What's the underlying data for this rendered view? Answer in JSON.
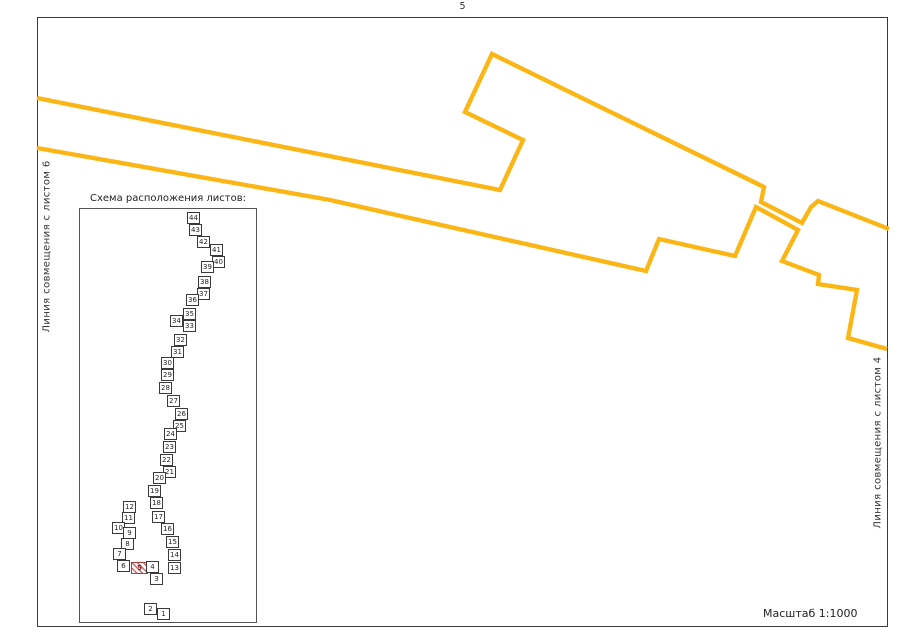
{
  "page": {
    "sheet_number": "5",
    "scale_label": "Масштаб 1:1000",
    "match_line_left": "Линия совмещения с листом 6",
    "match_line_right": "Линия совмещения с листом 4"
  },
  "scheme": {
    "title": "Схема расположения листов:",
    "current_sheet": 5,
    "sheets": [
      {
        "n": 1,
        "x": 157,
        "y": 608
      },
      {
        "n": 2,
        "x": 144,
        "y": 603
      },
      {
        "n": 3,
        "x": 150,
        "y": 573
      },
      {
        "n": 4,
        "x": 146,
        "y": 561
      },
      {
        "n": 5,
        "x": 131,
        "y": 562,
        "w": 17
      },
      {
        "n": 6,
        "x": 117,
        "y": 560
      },
      {
        "n": 7,
        "x": 113,
        "y": 548
      },
      {
        "n": 8,
        "x": 121,
        "y": 538
      },
      {
        "n": 9,
        "x": 123,
        "y": 527
      },
      {
        "n": 10,
        "x": 112,
        "y": 522
      },
      {
        "n": 11,
        "x": 122,
        "y": 512
      },
      {
        "n": 12,
        "x": 123,
        "y": 501
      },
      {
        "n": 13,
        "x": 168,
        "y": 562
      },
      {
        "n": 14,
        "x": 168,
        "y": 549
      },
      {
        "n": 15,
        "x": 166,
        "y": 536
      },
      {
        "n": 16,
        "x": 161,
        "y": 523
      },
      {
        "n": 17,
        "x": 152,
        "y": 511
      },
      {
        "n": 18,
        "x": 150,
        "y": 497
      },
      {
        "n": 19,
        "x": 148,
        "y": 485
      },
      {
        "n": 20,
        "x": 153,
        "y": 472
      },
      {
        "n": 21,
        "x": 163,
        "y": 466
      },
      {
        "n": 22,
        "x": 160,
        "y": 454
      },
      {
        "n": 23,
        "x": 163,
        "y": 441
      },
      {
        "n": 24,
        "x": 164,
        "y": 428
      },
      {
        "n": 25,
        "x": 173,
        "y": 420
      },
      {
        "n": 26,
        "x": 175,
        "y": 408
      },
      {
        "n": 27,
        "x": 167,
        "y": 395
      },
      {
        "n": 28,
        "x": 159,
        "y": 382
      },
      {
        "n": 29,
        "x": 161,
        "y": 369
      },
      {
        "n": 30,
        "x": 161,
        "y": 357
      },
      {
        "n": 31,
        "x": 171,
        "y": 346
      },
      {
        "n": 32,
        "x": 174,
        "y": 334
      },
      {
        "n": 33,
        "x": 183,
        "y": 320
      },
      {
        "n": 34,
        "x": 170,
        "y": 315
      },
      {
        "n": 35,
        "x": 183,
        "y": 308
      },
      {
        "n": 36,
        "x": 186,
        "y": 294
      },
      {
        "n": 37,
        "x": 197,
        "y": 288
      },
      {
        "n": 38,
        "x": 198,
        "y": 276
      },
      {
        "n": 39,
        "x": 201,
        "y": 261
      },
      {
        "n": 40,
        "x": 212,
        "y": 256
      },
      {
        "n": 41,
        "x": 210,
        "y": 244
      },
      {
        "n": 42,
        "x": 197,
        "y": 236
      },
      {
        "n": 43,
        "x": 189,
        "y": 224
      },
      {
        "n": 44,
        "x": 187,
        "y": 212
      }
    ]
  },
  "route": {
    "color": "#FBB615",
    "stroke_width": 4.4,
    "paths": [
      {
        "name": "route-upper-edge",
        "points": [
          [
            37,
            98
          ],
          [
            500,
            190
          ],
          [
            523,
            140
          ],
          [
            465,
            112
          ],
          [
            492,
            54
          ],
          [
            764,
            187
          ],
          [
            761,
            202
          ],
          [
            802,
            223
          ],
          [
            811,
            207
          ],
          [
            818,
            201
          ],
          [
            889,
            229
          ]
        ]
      },
      {
        "name": "route-lower-edge",
        "points": [
          [
            37,
            148
          ],
          [
            330,
            200
          ],
          [
            646,
            271
          ],
          [
            659,
            239
          ],
          [
            735,
            256
          ],
          [
            756,
            207
          ],
          [
            798,
            230
          ],
          [
            782,
            261
          ],
          [
            819,
            275
          ],
          [
            818,
            284
          ],
          [
            857,
            290
          ],
          [
            848,
            338
          ],
          [
            887,
            349
          ]
        ]
      }
    ]
  }
}
